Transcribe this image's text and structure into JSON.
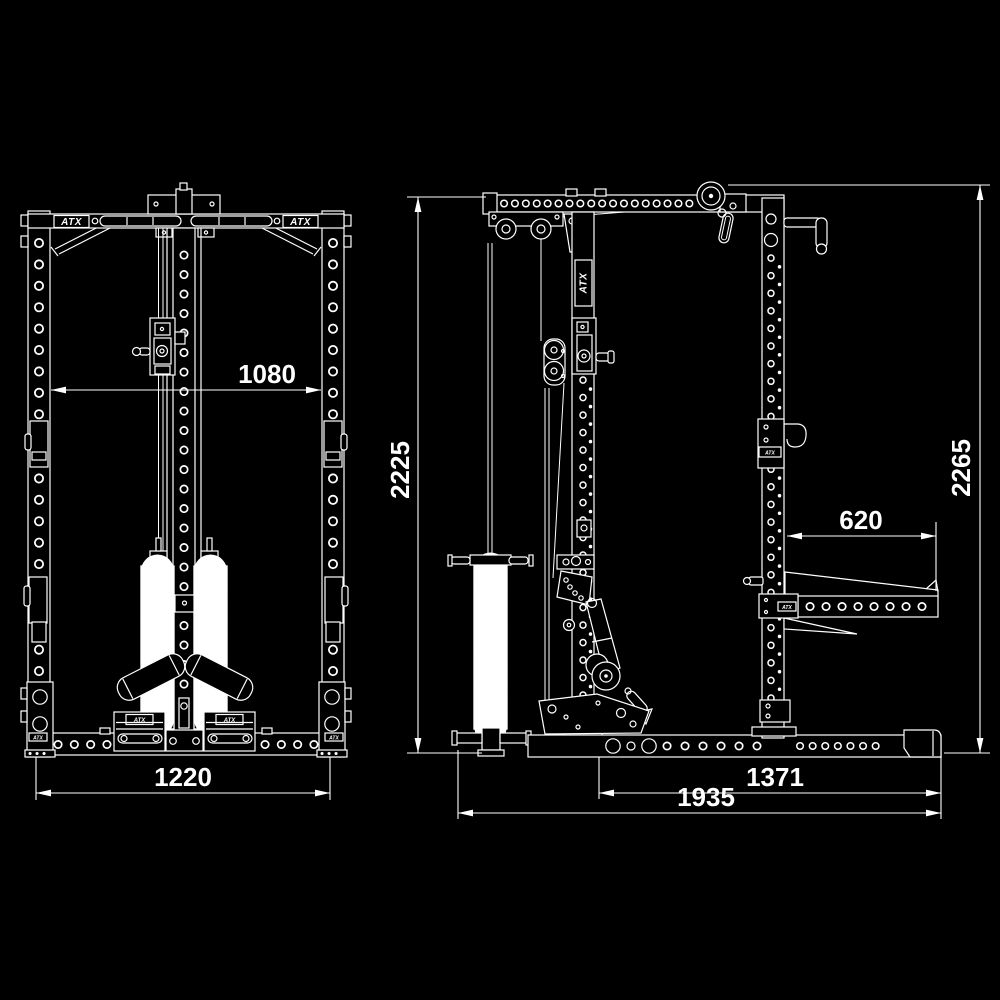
{
  "colors": {
    "background": "#000000",
    "line": "#ffffff"
  },
  "brand": "ATX",
  "front_view": {
    "dims": {
      "inner_width": "1080",
      "overall_width": "1220"
    }
  },
  "side_view": {
    "dims": {
      "front_height": "2225",
      "overall_height": "2265",
      "safety_arm": "620",
      "rack_depth": "1371",
      "overall_depth": "1935"
    }
  }
}
